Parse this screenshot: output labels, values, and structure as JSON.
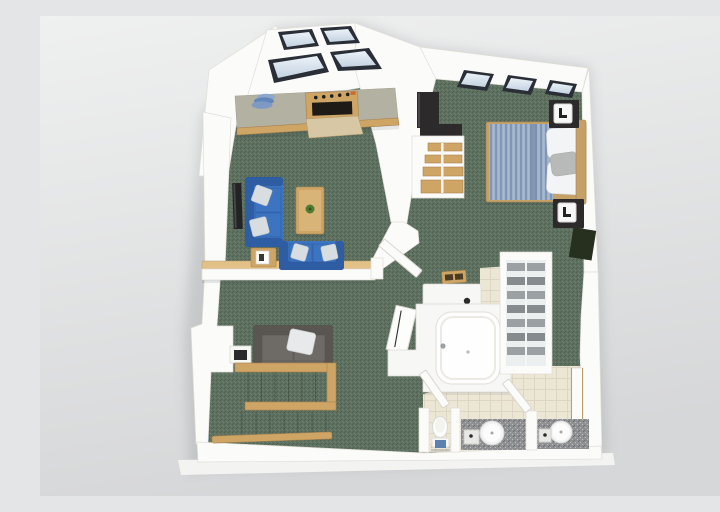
{
  "scene": {
    "label": "3D rendered apartment floor plan, top-down dollhouse view",
    "flooring": {
      "main": "green carpet",
      "bathroom": "cream tile",
      "stairs": "green carpet"
    }
  },
  "rooms": [
    {
      "id": "kitchen",
      "name": "kitchen",
      "furniture": [
        "window-wall",
        "counter",
        "stacked-plates",
        "range-stove",
        "open-oven-door"
      ]
    },
    {
      "id": "living-room",
      "name": "living room",
      "furniture": [
        "wall-tv",
        "blue-sofa",
        "blue-loveseat",
        "coffee-table",
        "potted-plant",
        "end-table",
        "picture-frame"
      ]
    },
    {
      "id": "family-room",
      "name": "family room",
      "furniture": [
        "gray-loveseat",
        "throw-pillow",
        "tv-stand",
        "staircase",
        "wood-railing",
        "handrail"
      ]
    },
    {
      "id": "bedroom",
      "name": "bedroom",
      "furniture": [
        "double-bed-striped-duvet",
        "pillows",
        "headboard",
        "nightstand-upper",
        "nightstand-lower",
        "table-lamps",
        "dark-wardrobe",
        "closet-wood-shelves",
        "dark-rug",
        "windows"
      ]
    },
    {
      "id": "bathroom",
      "name": "bathroom",
      "furniture": [
        "vanity-counter",
        "faucet",
        "leaning-mirror",
        "bathtub",
        "linen-shelves",
        "toilet",
        "towel-rack",
        "sink-left",
        "sink-right",
        "granite-counters",
        "swing-doors",
        "floor-vent"
      ]
    }
  ],
  "colors": {
    "bg-top": "#eff0f0",
    "bg-bottom": "#d6d7d8",
    "slab": "#f3f3f1",
    "wall": "#fbfbfa",
    "wall-edge": "#e1ded7",
    "carpet": "#5e705f",
    "carpet-dark": "#4e5f50",
    "carpet-light": "#6d7f6e",
    "step-line": "#3d4c3f",
    "tile": "#ece6d5",
    "tile-line": "#ded6c2",
    "wood": "#cfa566",
    "wood-light": "#e2c188",
    "wood-dark": "#a8824c",
    "counter-top": "#b3b1a2",
    "oven-black": "#1e1b17",
    "oven-door": "#d8c7a4",
    "accent-orange": "#c96a2a",
    "sofa-blue": "#3d74c0",
    "sofa-blue-dark": "#2e5da3",
    "pillow-light": "#d8dde2",
    "sofa-gray": "#6e6a66",
    "sofa-gray-dark": "#595551",
    "bed-base": "#9db1c9",
    "bed-stripe": "#8196b5",
    "bed-frame": "#c5a168",
    "linen-white": "#f3f4f5",
    "pillow-gray": "#b7bab8",
    "dark-furniture": "#2d2a2b",
    "window-frame": "#2a2e36",
    "glass-light": "#ecf2f8",
    "glass-dark": "#c3d2e1",
    "granite": "#8e9092",
    "granite-light": "#bbbdbe",
    "granite-dark": "#6d6f71",
    "fixture": "#f7f7f5",
    "fixture-edge": "#dcdad3",
    "towel-blue": "#5e80ae",
    "rug-dark": "#27301f",
    "plant": "#4f7d2f",
    "shadow": "#1c2430"
  }
}
